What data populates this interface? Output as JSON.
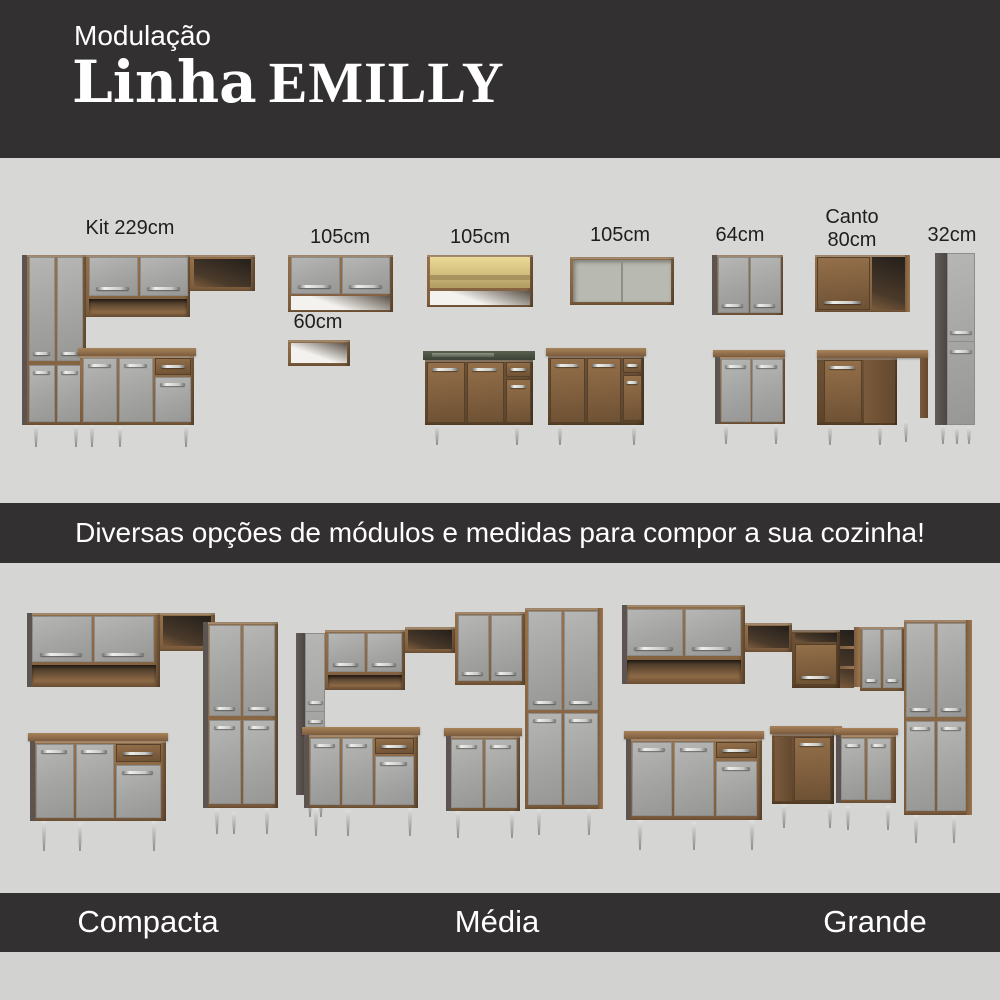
{
  "header": {
    "eyebrow": "Modulação",
    "title_line": "Linha",
    "title_brand": "EMILLY"
  },
  "modules": [
    {
      "id": "kit-229",
      "label": "Kit 229cm"
    },
    {
      "id": "aereo-105",
      "label": "105cm"
    },
    {
      "id": "nicho-60",
      "label": "60cm"
    },
    {
      "id": "aereo-105-vidro",
      "label": "105cm"
    },
    {
      "id": "aereo-105-aberto",
      "label": "105cm"
    },
    {
      "id": "aereo-64",
      "label": "64cm"
    },
    {
      "id": "canto-80",
      "label_line1": "Canto",
      "label_line2": "80cm"
    },
    {
      "id": "paneleiro-32",
      "label": "32cm"
    }
  ],
  "tagline": "Diversas opções de módulos e medidas para compor a sua cozinha!",
  "kitchen_sizes": [
    {
      "label": "Compacta"
    },
    {
      "label": "Média"
    },
    {
      "label": "Grande"
    }
  ],
  "colors": {
    "banner_bg": "#333031",
    "section_bg": "#d7d7d5",
    "door_gray": "#a9a9a7",
    "wood_brown": "#8a6845",
    "countertop_sink": "#4e564c",
    "text_light": "#ffffff",
    "text_dark": "#1e1e1c"
  }
}
